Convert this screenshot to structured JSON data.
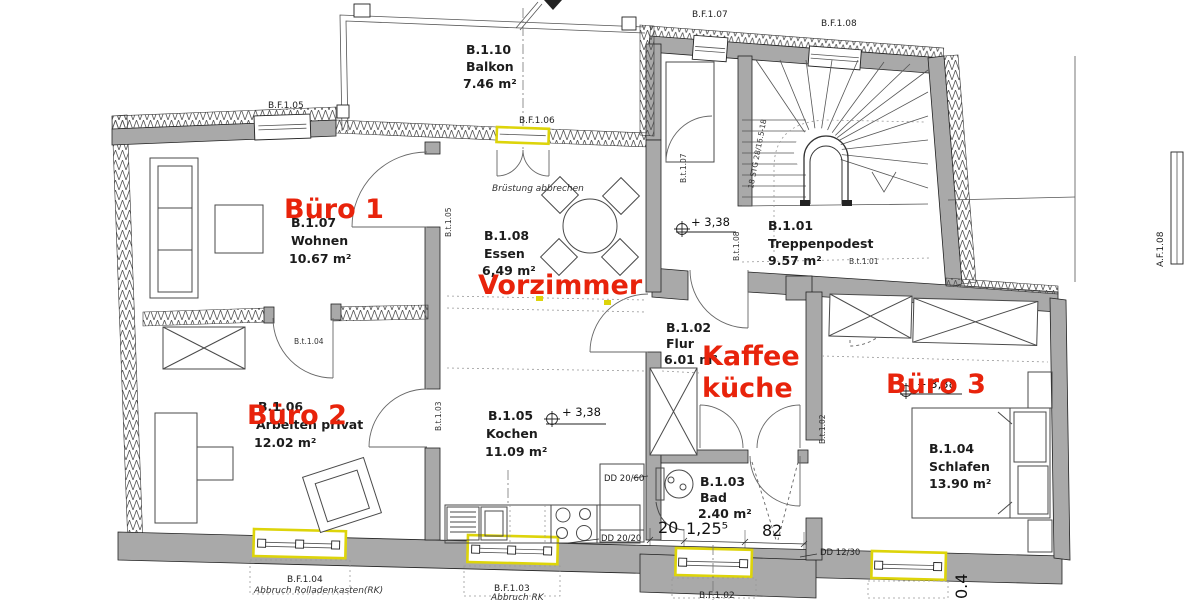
{
  "colors": {
    "wall_gray": "#a9a9a9",
    "annotation_red": "#e8230b",
    "window_highlight_yellow": "#ddd40a",
    "line_black": "#222222"
  },
  "red": {
    "b1": "Büro 1",
    "vz": "Vorzimmer",
    "b2": "Büro 2",
    "k1": "Kaffee",
    "k2": "küche",
    "b3": "Büro 3"
  },
  "rooms": {
    "balkon": {
      "code": "B.1.10",
      "name": "Balkon",
      "area": "7.46 m²"
    },
    "wohnen": {
      "code": "B.1.07",
      "name": "Wohnen",
      "area": "10.67 m²"
    },
    "essen": {
      "code": "B.1.08",
      "name": "Essen",
      "area": "6,49 m²"
    },
    "treppenpodest": {
      "code": "B.1.01",
      "name": "Treppenpodest",
      "area": "9.57 m²"
    },
    "flur": {
      "code": "B.1.02",
      "name": "Flur",
      "area": "6.01 m²"
    },
    "arbeiten": {
      "code": "B.1.06",
      "name": "Arbeiten privat",
      "area": "12.02 m²"
    },
    "kochen": {
      "code": "B.1.05",
      "name": "Kochen",
      "area": "11.09 m²"
    },
    "bad": {
      "code": "B.1.03",
      "name": "Bad",
      "area": "2.40 m²"
    },
    "schlafen": {
      "code": "B.1.04",
      "name": "Schlafen",
      "area": "13.90 m²"
    }
  },
  "wins": {
    "f05": "B.F.1.05",
    "f06": "B.F.1.06",
    "f07": "B.F.1.07",
    "f08": "B.F.1.08",
    "f04": "B.F.1.04",
    "f03": "B.F.1.03",
    "f02": "B.F.1.02",
    "af08": "A.F.1.08"
  },
  "doors": {
    "t01": "B.t.1.01",
    "t02": "B.t.1.02",
    "t03": "B.t.1.03",
    "t04": "B.t.1.04",
    "t05": "B.t.1.05",
    "t07": "B.t.1.07",
    "t08": "B.t.1.08"
  },
  "notes": {
    "bruestung": "Brüstung abbrechen",
    "abbruch_long": "Abbruch Rolladenkasten(RK)",
    "abbruch_short": "Abbruch RK",
    "stairs": "18 STG 28/16.5-18"
  },
  "levels": {
    "l_flur": "+ 3,38",
    "l_kochen": "+ 3,38",
    "l_schlafen": "+ 3,38"
  },
  "dims": {
    "w20": "20",
    "w125": "1,25⁵",
    "w82": "82",
    "dd2060": "DD 20/60",
    "dd2020": "DD 20/20",
    "dd1230": "DD 12/30",
    "t04": "0.4"
  }
}
